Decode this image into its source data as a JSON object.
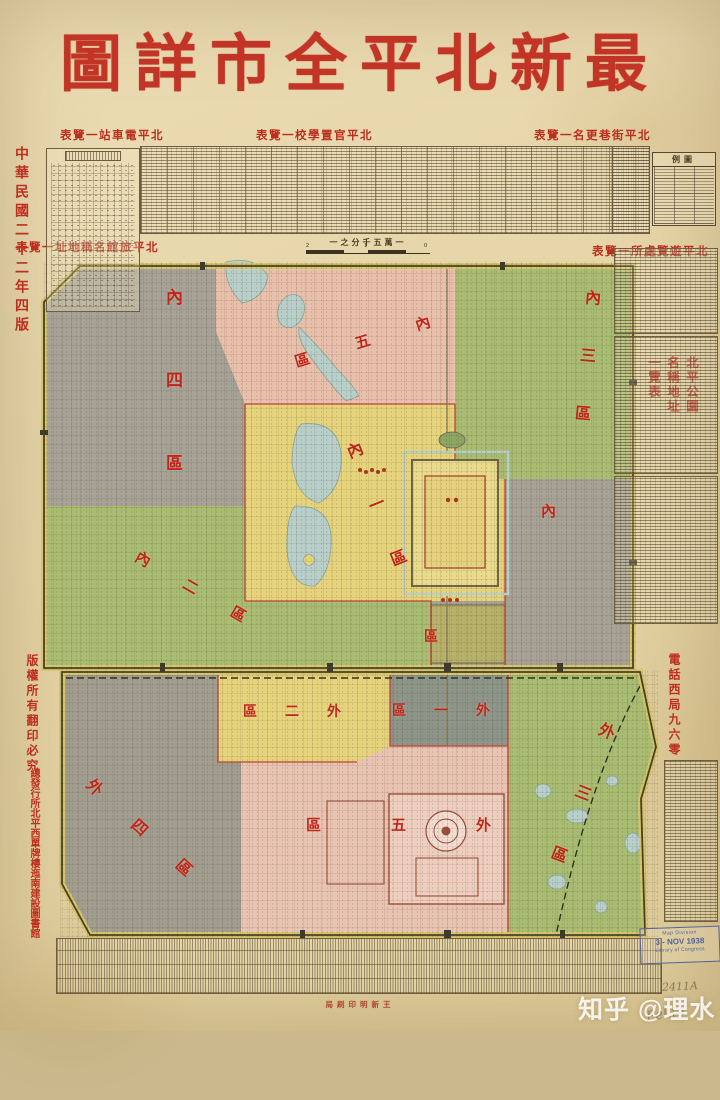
{
  "title": "圖詳市全平北新最",
  "edition": "中華民國二十二年四版",
  "section_headers": {
    "tram": "表覽一站車電平北",
    "schools": "表覽一校學置官平北",
    "street_renames": "表覽一名更巷街平北",
    "hotels": "表覽一址地稱名館旅平北",
    "sights": "表覽一所處覽遊平北",
    "parks": "北平公園名稱地址一覽表"
  },
  "scale": {
    "label": "一之分千五萬一",
    "tick_left": "2",
    "tick_mid": "1",
    "tick_right": "0"
  },
  "legend_title": "例圖",
  "side_notes": {
    "copyright": "版權所有翻印必究",
    "publisher": "總發行所北平西單牌樓迤南建設圖書館",
    "phone": "電話西局九六零",
    "printer": "局刷印明新王"
  },
  "districts": [
    {
      "id": "nei-1",
      "label": "內一區"
    },
    {
      "id": "nei-2",
      "label": "內二區"
    },
    {
      "id": "nei-3",
      "label": "內三區"
    },
    {
      "id": "nei-4",
      "label": "內四區"
    },
    {
      "id": "nei-5",
      "label": "區五內"
    },
    {
      "id": "nei-6-partial",
      "label": "內"
    },
    {
      "id": "legation-partial",
      "label": "區"
    },
    {
      "id": "wai-1",
      "label": "區一外"
    },
    {
      "id": "wai-2",
      "label": "區二外"
    },
    {
      "id": "wai-3",
      "label": "外三區"
    },
    {
      "id": "wai-4",
      "label": "外四區"
    },
    {
      "id": "wai-5",
      "label": "區五外"
    }
  ],
  "stamp": {
    "line1": "Map Division",
    "line2": "3 - NOV 1938",
    "line3": "Library of Congress"
  },
  "annotations": {
    "call_number": "2411A",
    "signature": "Pekin"
  },
  "watermark": "知乎 @理水",
  "colors": {
    "title_red": "#c23425",
    "label_red": "#c0251a",
    "paper": "#e7d6aa",
    "district_green": "#a9bd72",
    "district_pink": "#e8c0ab",
    "district_yellow": "#e6d47c",
    "district_gray": "#a6a295",
    "wall_yellow": "#d9c569",
    "lake_blue": "#b9cfc9"
  }
}
